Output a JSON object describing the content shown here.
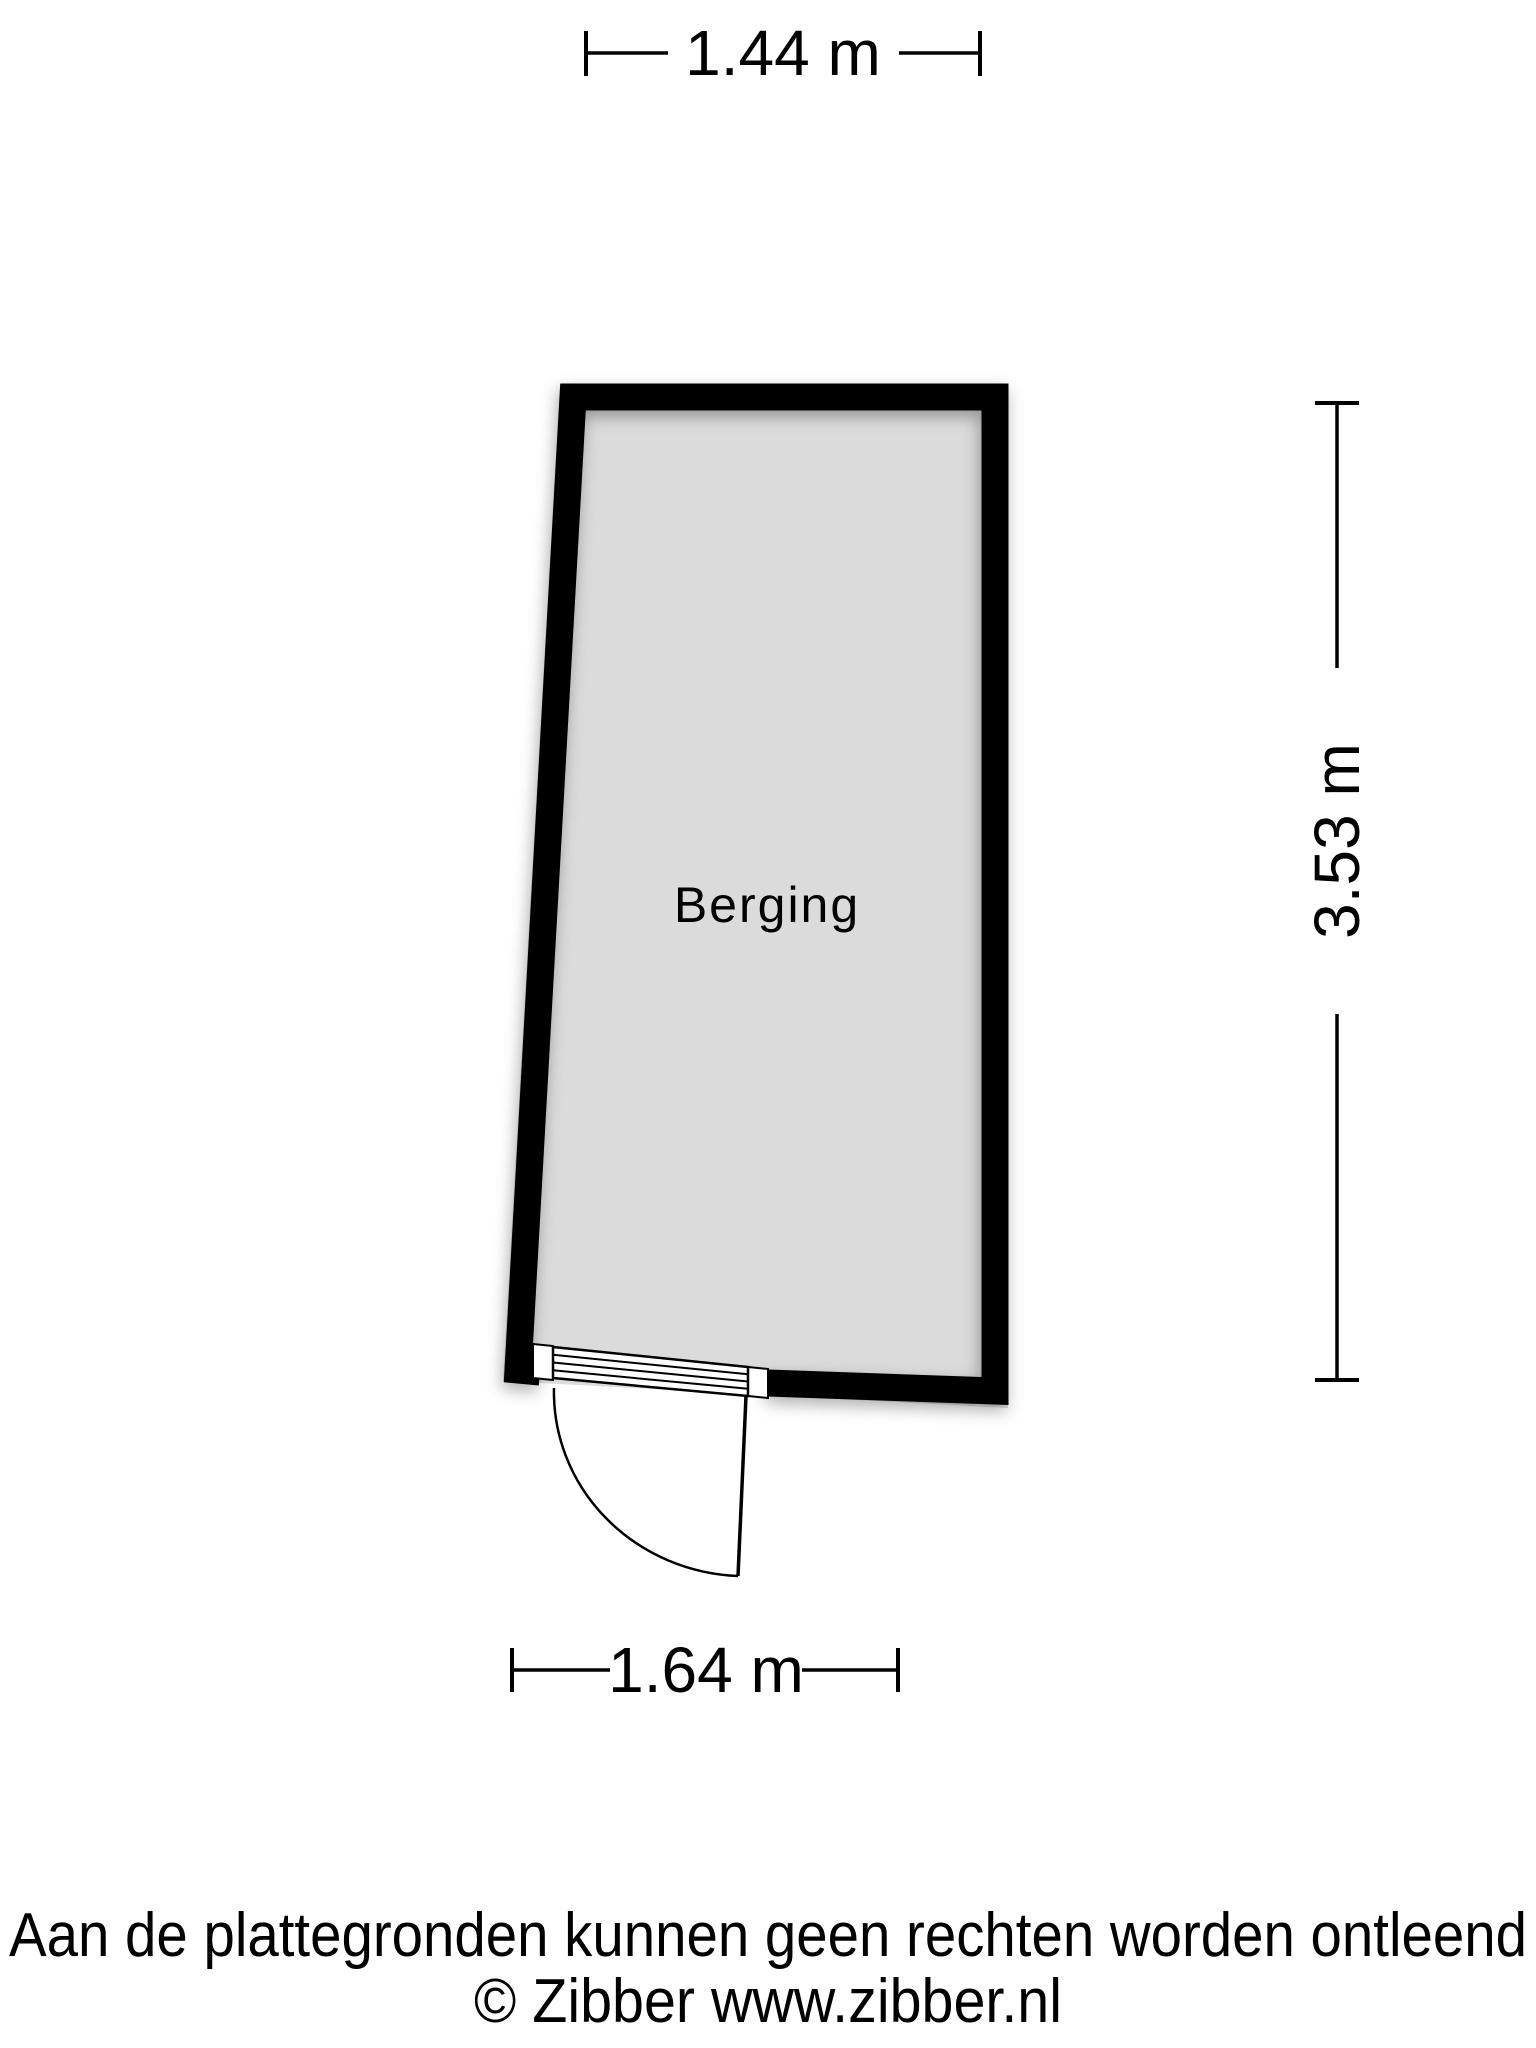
{
  "room": {
    "label": "Berging"
  },
  "dimensions": {
    "top": "1.44 m",
    "right": "3.53 m",
    "bottom": "1.64 m"
  },
  "footer": {
    "disclaimer": "Aan de plattegronden kunnen geen rechten worden ontleend",
    "copyright": "© Zibber www.zibber.nl"
  },
  "colors": {
    "wall": "#000000",
    "floor": "#dbdbdb",
    "background": "#ffffff",
    "line": "#000000"
  }
}
